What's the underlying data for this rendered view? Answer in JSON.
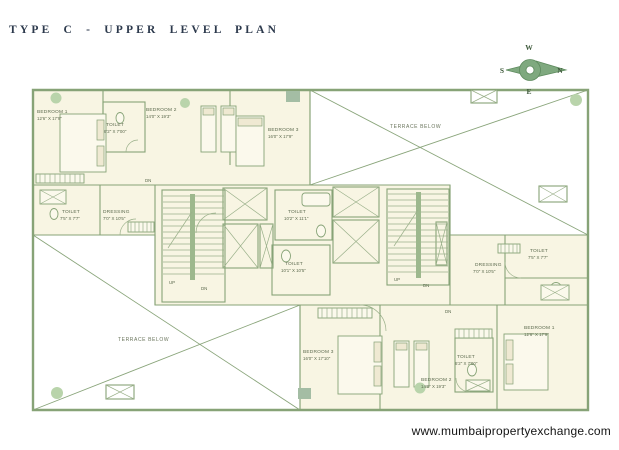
{
  "title": "TYPE C - UPPER LEVEL PLAN",
  "footer_url": "www.mumbaipropertyexchange.com",
  "compass": {
    "north": "N",
    "south": "S",
    "east": "E",
    "west": "W"
  },
  "colors": {
    "wall_green": "#87a377",
    "room_fill": "#f8f5e3",
    "column_green": "#b9d4ab",
    "title_ink": "#2d3a4d"
  },
  "terrace": {
    "top_label": "TERRACE BELOW",
    "bottom_label": "TERRACE BELOW"
  },
  "stairs": {
    "up": "UP",
    "down": "DN"
  },
  "units": {
    "upper_left": {
      "bedroom1": {
        "name": "BEDROOM 1",
        "dims": "12'6\" X 17'9\""
      },
      "toilet1": {
        "name": "TOILET",
        "dims": "6'2\" X 7'00\""
      },
      "bedroom2": {
        "name": "BEDROOM 2",
        "dims": "14'0\" X 19'3\""
      },
      "bedroom3": {
        "name": "BEDROOM 3",
        "dims": "16'0\" X 17'9\""
      },
      "toilet2": {
        "name": "TOILET",
        "dims": "7'5\" X 7'7\""
      },
      "dressing": {
        "name": "DRESSING",
        "dims": "7'0\" X 10'5\""
      }
    },
    "core": {
      "toilet_upper": {
        "name": "TOILET",
        "dims": "10'2\" X 11'1\""
      },
      "toilet_lower": {
        "name": "TOILET",
        "dims": "10'1\" X 10'5\""
      }
    },
    "lower_right": {
      "bedroom3": {
        "name": "BEDROOM 3",
        "dims": "16'0\" X 17'10\""
      },
      "bedroom2": {
        "name": "BEDROOM 2",
        "dims": "14'0\" X 19'3\""
      },
      "toilet1": {
        "name": "TOILET",
        "dims": "6'2\" X 7'00\""
      },
      "bedroom1": {
        "name": "BEDROOM 1",
        "dims": "12'6\" X 17'9\""
      },
      "toilet2": {
        "name": "TOILET",
        "dims": "7'5\" X 7'7\""
      },
      "dressing": {
        "name": "DRESSING",
        "dims": "7'0\" X 10'5\""
      }
    }
  }
}
